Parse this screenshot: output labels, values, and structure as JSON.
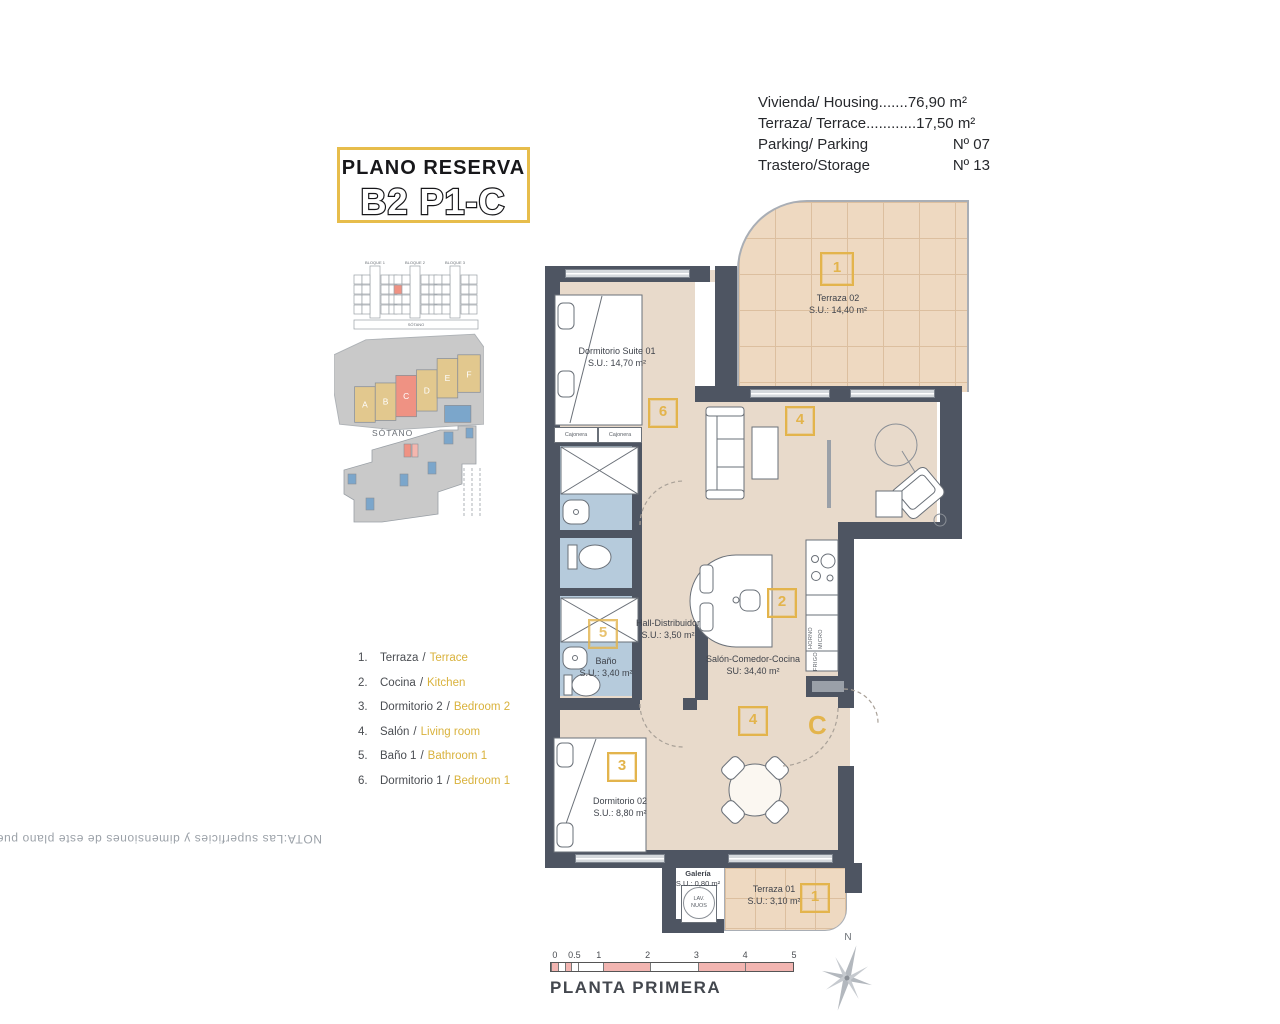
{
  "note": "NOTA:Las superficies y dimensiones de este plano pueden ser sometidas a modificaciones durante la obra, no teniendo valor contractual.",
  "title": {
    "line1": "PLANO RESERVA",
    "line2": "B2 P1-C"
  },
  "info_rows": [
    {
      "label": "Vivienda/ Housing.......",
      "value": "76,90 m²"
    },
    {
      "label": "Terraza/ Terrace............",
      "value": "17,50 m²"
    },
    {
      "label": "Parking/ Parking",
      "value": "Nº 07"
    },
    {
      "label": "Trastero/Storage",
      "value": "Nº 13"
    }
  ],
  "site": {
    "elevation_blocks": [
      "BLOQUE 1",
      "BLOQUE 2",
      "BLOQUE 3"
    ],
    "elevation_basement": "SÓTANO",
    "buildings": [
      "A",
      "B",
      "C",
      "D",
      "E",
      "F"
    ],
    "sotano_label": "SÓTANO"
  },
  "legend": {
    "separator": "/",
    "items": [
      {
        "num": "1.",
        "es": "Terraza",
        "en": "Terrace"
      },
      {
        "num": "2.",
        "es": "Cocina",
        "en": "Kitchen"
      },
      {
        "num": "3.",
        "es": "Dormitorio 2",
        "en": "Bedroom 2"
      },
      {
        "num": "4.",
        "es": "Salón",
        "en": "Living room"
      },
      {
        "num": "5.",
        "es": "Baño 1",
        "en": "Bathroom 1"
      },
      {
        "num": "6.",
        "es": "Dormitorio 1",
        "en": "Bedroom 1"
      }
    ]
  },
  "plan": {
    "rooms": {
      "terraza02": {
        "name": "Terraza 02",
        "area": "S.U.: 14,40 m²"
      },
      "suite": {
        "name": "Dormitorio Suite 01",
        "area": "S.U.: 14,70 m²"
      },
      "hall": {
        "name": "Hall-Distribuidor",
        "area": "S.U.: 3,50 m²"
      },
      "bano": {
        "name": "Baño",
        "area": "S.U.: 3,40 m²"
      },
      "salon": {
        "name": "Salón-Comedor-Cocina",
        "area": "SU: 34,40 m²"
      },
      "dorm02": {
        "name": "Dormitorio 02",
        "area": "S.U.: 8,80 m²"
      },
      "galeria": {
        "name": "Galería",
        "area": "S.U.: 0,80 m²"
      },
      "terraza01": {
        "name": "Terraza 01",
        "area": "S.U.: 3,10 m²"
      }
    },
    "markers": {
      "terraza02": "1",
      "suite": "6",
      "salon_top": "4",
      "cocina": "2",
      "bano": "5",
      "salon_bottom": "4",
      "dorm02": "3",
      "terraza01": "1"
    },
    "unit_letter": "C",
    "labels": {
      "cajonera": "Cajonera",
      "horno": "HORNO",
      "micro": "MICRO",
      "frigo": "FRIGO",
      "lav_line1": "LAV.",
      "lav_line2": "NUOS"
    }
  },
  "scale": {
    "ticks": [
      "0",
      "0.5",
      "1",
      "2",
      "3",
      "4",
      "5"
    ],
    "caption": "PLANTA PRIMERA"
  },
  "compass": {
    "north": "N"
  },
  "colors": {
    "accent_yellow": "#e3b44c",
    "wall": "#4e5562",
    "floor_tan": "#e8dacb",
    "terrace_tan": "#eed9c1",
    "bath_blue": "#b6cbdc",
    "highlight_salmon": "#ef9283",
    "building_tan": "#e2c88e",
    "building_blue": "#7ba6cb",
    "scale_pink": "#f2b5b1"
  }
}
